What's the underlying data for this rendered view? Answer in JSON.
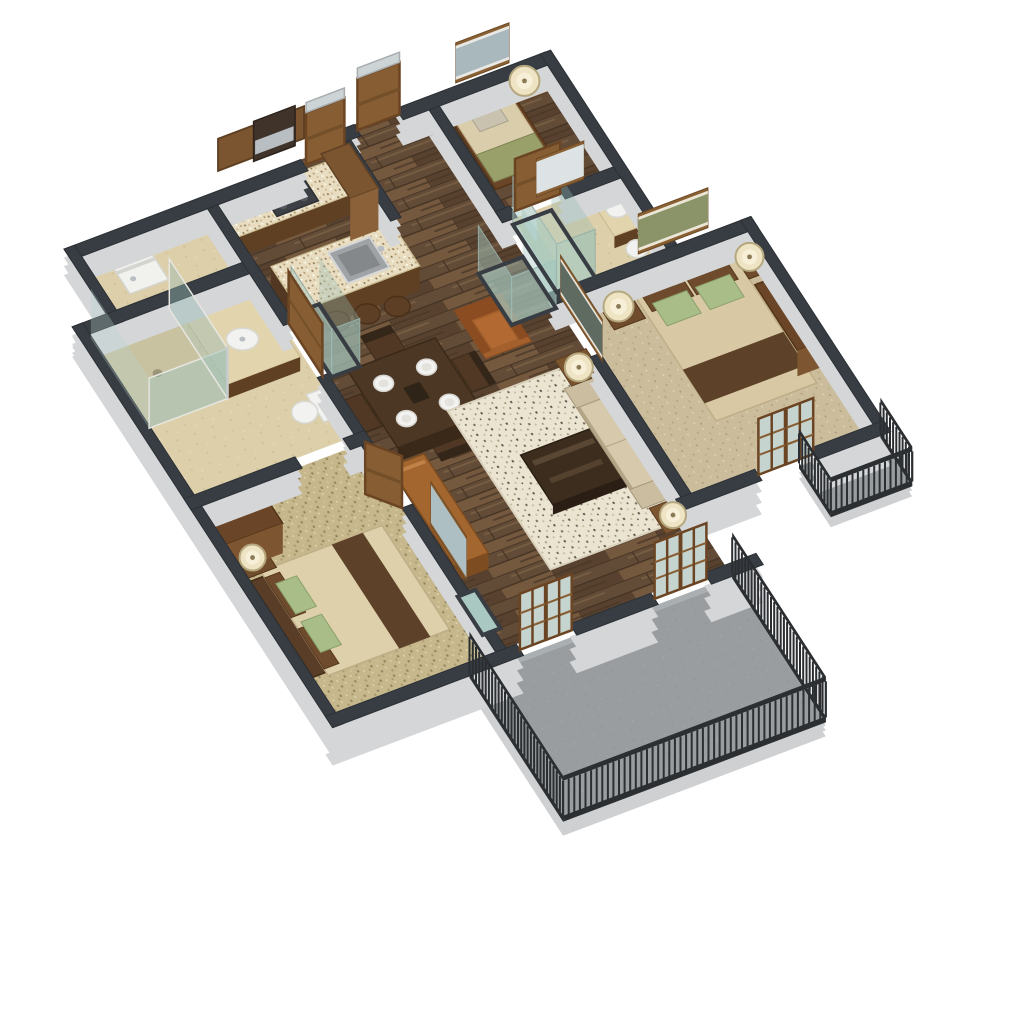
{
  "scene": {
    "title": "3D isometric apartment floor plan render",
    "view": "axonometric top-down cutaway",
    "background": "#ffffff"
  },
  "colors": {
    "wallCap": "#383d43",
    "wallEdge": "#2b3035",
    "wallFace": "#d5d6d8",
    "wallFaceLight": "#e4e5e7",
    "woodBase": "#6e5741",
    "tile": "#dccfa9",
    "carpet": "#c6b78c",
    "carpetMaster": "#cbbd9c",
    "rug": "#ebe4d1",
    "granite": "#e8ddc1",
    "graniteRim": "#c9b98e",
    "cabinet": "#7b5530",
    "cabinetDark": "#5f4023",
    "woodDoor": "#875e33",
    "doorFrame": "#6b4523",
    "tableDark": "#4c3624",
    "coffeeTable": "#3c2d1f",
    "sofa": "#cbbda0",
    "sofaBase": "#b3a586",
    "seatCushion": "#d6c9ac",
    "accentChair": "#a3602c",
    "sideboard": "#a4662f",
    "bedSpread": "#d8c9a4",
    "bedSpread2": "#ddd0ab",
    "bedRunner": "#5d4128",
    "pillowGreen": "#a9bd88",
    "pillowBrown": "#6d4b2c",
    "headboard": "#5a3d26",
    "nightstand": "#6f4c2c",
    "wardrobe": "#6b4527",
    "lampShade": "#eee3c2",
    "lampRing": "#b5a87f",
    "fixtureWhite": "#f2f2f0",
    "fixtureEdge": "#d8d8d2",
    "glassTeal": "rgba(165,200,192,0.50)",
    "glassTealSolid": "#a9c8c2",
    "glassStroke": "#93aaa4",
    "balconyFloor": "#9a9d9f",
    "balconyEdge": "#cfd0d2",
    "railing": "#2c2f32",
    "artWood": "#8a6134",
    "metal": "#b9bec2",
    "hood": "#40332a",
    "cooktop": "#3d4146",
    "sinkSteel": "#9fa3a6",
    "mirrorGlass": "#dde2e4",
    "artSky": "#a8b8bd",
    "artLand": "#8a9468",
    "artDark": "#5f6a61"
  },
  "rooms": [
    {
      "id": "kitchen",
      "label": "Kitchen"
    },
    {
      "id": "dining",
      "label": "Dining Area"
    },
    {
      "id": "living",
      "label": "Living Room"
    },
    {
      "id": "hall",
      "label": "Entry Hall"
    },
    {
      "id": "den",
      "label": "Den / Study"
    },
    {
      "id": "bath2",
      "label": "Hall Bathroom"
    },
    {
      "id": "master-bedroom",
      "label": "Master Bedroom"
    },
    {
      "id": "bedroom2",
      "label": "Second Bedroom"
    },
    {
      "id": "bath1",
      "label": "Main Bathroom"
    },
    {
      "id": "laundry",
      "label": "Laundry Closet"
    },
    {
      "id": "balcony-main",
      "label": "Main Balcony"
    },
    {
      "id": "balcony-juliet",
      "label": "Bedroom Balcony"
    }
  ],
  "furniture": {
    "kitchen": [
      "upper-cabinets",
      "range-hood",
      "cooktop",
      "granite-counter",
      "refrigerator",
      "island-with-sink",
      "bar-stools"
    ],
    "dining": [
      "dining-table",
      "four-chairs",
      "four-place-settings",
      "sideboard"
    ],
    "living": [
      "sofa",
      "coffee-table",
      "area-rug",
      "accent-armchair",
      "two-side-tables",
      "two-lamps",
      "wall-art"
    ],
    "den": [
      "daybed",
      "side-table",
      "lamp",
      "wall-art"
    ],
    "bath2": [
      "vanity",
      "toilet",
      "mirror"
    ],
    "master-bedroom": [
      "queen-bed",
      "two-nightstands",
      "two-lamps",
      "wardrobe",
      "wall-art",
      "french-doors"
    ],
    "bedroom2": [
      "bed",
      "nightstand",
      "lamp",
      "wardrobe",
      "wall-mirror"
    ],
    "bath1": [
      "glass-shower",
      "vanity-sink",
      "toilet"
    ],
    "laundry": [
      "stacked-washer-dryer"
    ]
  },
  "counts": {
    "bedrooms": 2,
    "bathrooms": 2,
    "balconies": 2,
    "dining_plates": 4,
    "bar_stools": 3,
    "french_door_sets": 3
  }
}
